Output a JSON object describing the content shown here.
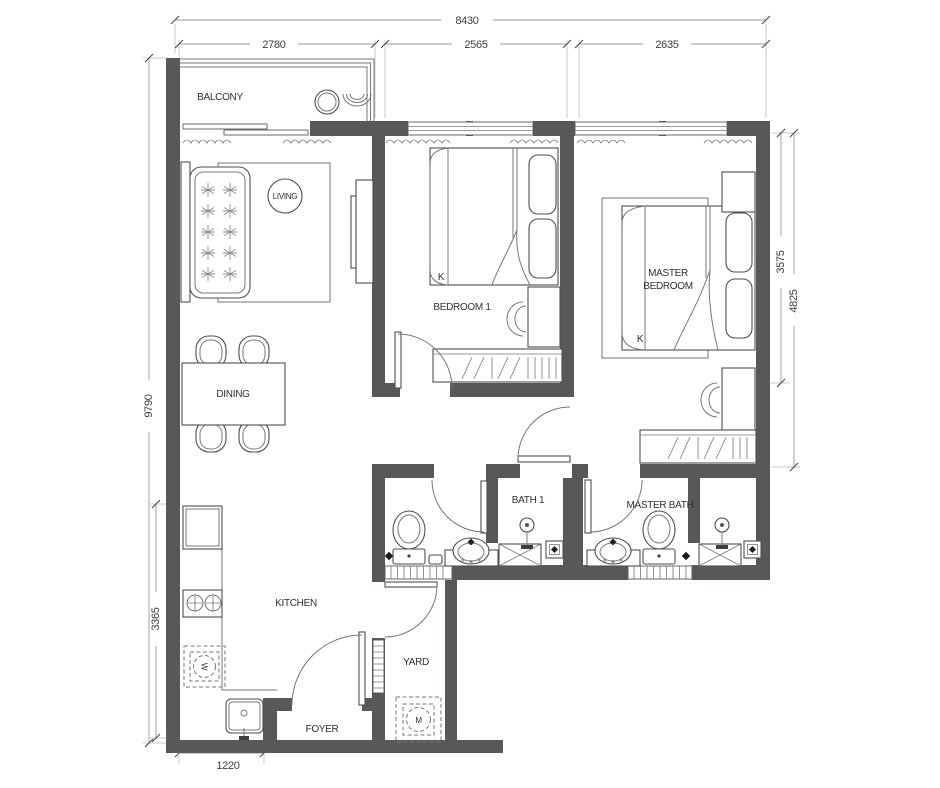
{
  "fp": {
    "rooms": {
      "balcony": "BALCONY",
      "living": "LIVING",
      "bedroom1": "BEDROOM 1",
      "master_line1": "MASTER",
      "master_line2": "BEDROOM",
      "dining": "DINING",
      "kitchen": "KITCHEN",
      "bath1": "BATH 1",
      "master_bath": "MASTER BATH",
      "yard": "YARD",
      "foyer": "FOYER"
    },
    "beds": {
      "bedroom1": "K",
      "master": "K"
    },
    "appliances": {
      "washer": "W",
      "yard_machine": "M"
    },
    "dimensions": {
      "total_width": "8430",
      "balcony_width": "2780",
      "bedroom1_width": "2565",
      "master_bedroom_width": "2635",
      "total_depth": "9790",
      "kitchen_depth": "3365",
      "entry_width": "1220",
      "master_depth": "3575",
      "master_overall_depth": "4825"
    },
    "colors": {
      "wall": "#57585a",
      "furniture_line": "#777777",
      "dim_line": "#9a9a9a",
      "text": "#2f2f2f"
    }
  }
}
